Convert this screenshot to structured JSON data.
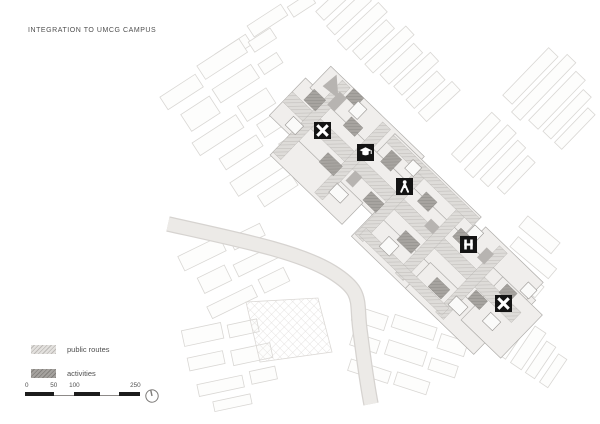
{
  "page": {
    "title": "INTEGRATION TO UMCG CAMPUS",
    "background": "#ffffff"
  },
  "legend": {
    "items": [
      {
        "id": "public-routes",
        "label": "public routes",
        "swatch_style": "light-diagonal-hatch"
      },
      {
        "id": "activities",
        "label": "activities",
        "swatch_style": "dark-diagonal-hatch"
      }
    ]
  },
  "scale_bar": {
    "tick_labels": [
      "0",
      "50",
      "100",
      "250"
    ]
  },
  "icons": {
    "north_indicator": "circle-with-top-tick"
  },
  "map": {
    "markers": [
      {
        "id": "route-node-marker-west",
        "glyph": "x-cross",
        "x": 322,
        "y": 130
      },
      {
        "id": "education-marker",
        "glyph": "graduation-cap",
        "x": 365,
        "y": 152
      },
      {
        "id": "activity-person-marker",
        "glyph": "person",
        "x": 404,
        "y": 186
      },
      {
        "id": "hospital-marker",
        "glyph": "hospital-h",
        "x": 468,
        "y": 244
      },
      {
        "id": "route-node-marker-south",
        "glyph": "x-cross",
        "x": 503,
        "y": 303
      }
    ],
    "colors": {
      "route_hatch_bg": "#d9d7d4",
      "route_hatch_line": "#bfbcb9",
      "activity_hatch_bg": "#a7a4a0",
      "activity_hatch_line": "#8e8b87",
      "campus_base": "#f0eeec",
      "campus_stroke": "#b0aeab",
      "fabric_stroke": "#d9d7d4",
      "canal_fill": "#ebe9e6",
      "marker_bg": "#141414",
      "marker_fg": "#ffffff",
      "text": "#4f4f4f"
    }
  }
}
